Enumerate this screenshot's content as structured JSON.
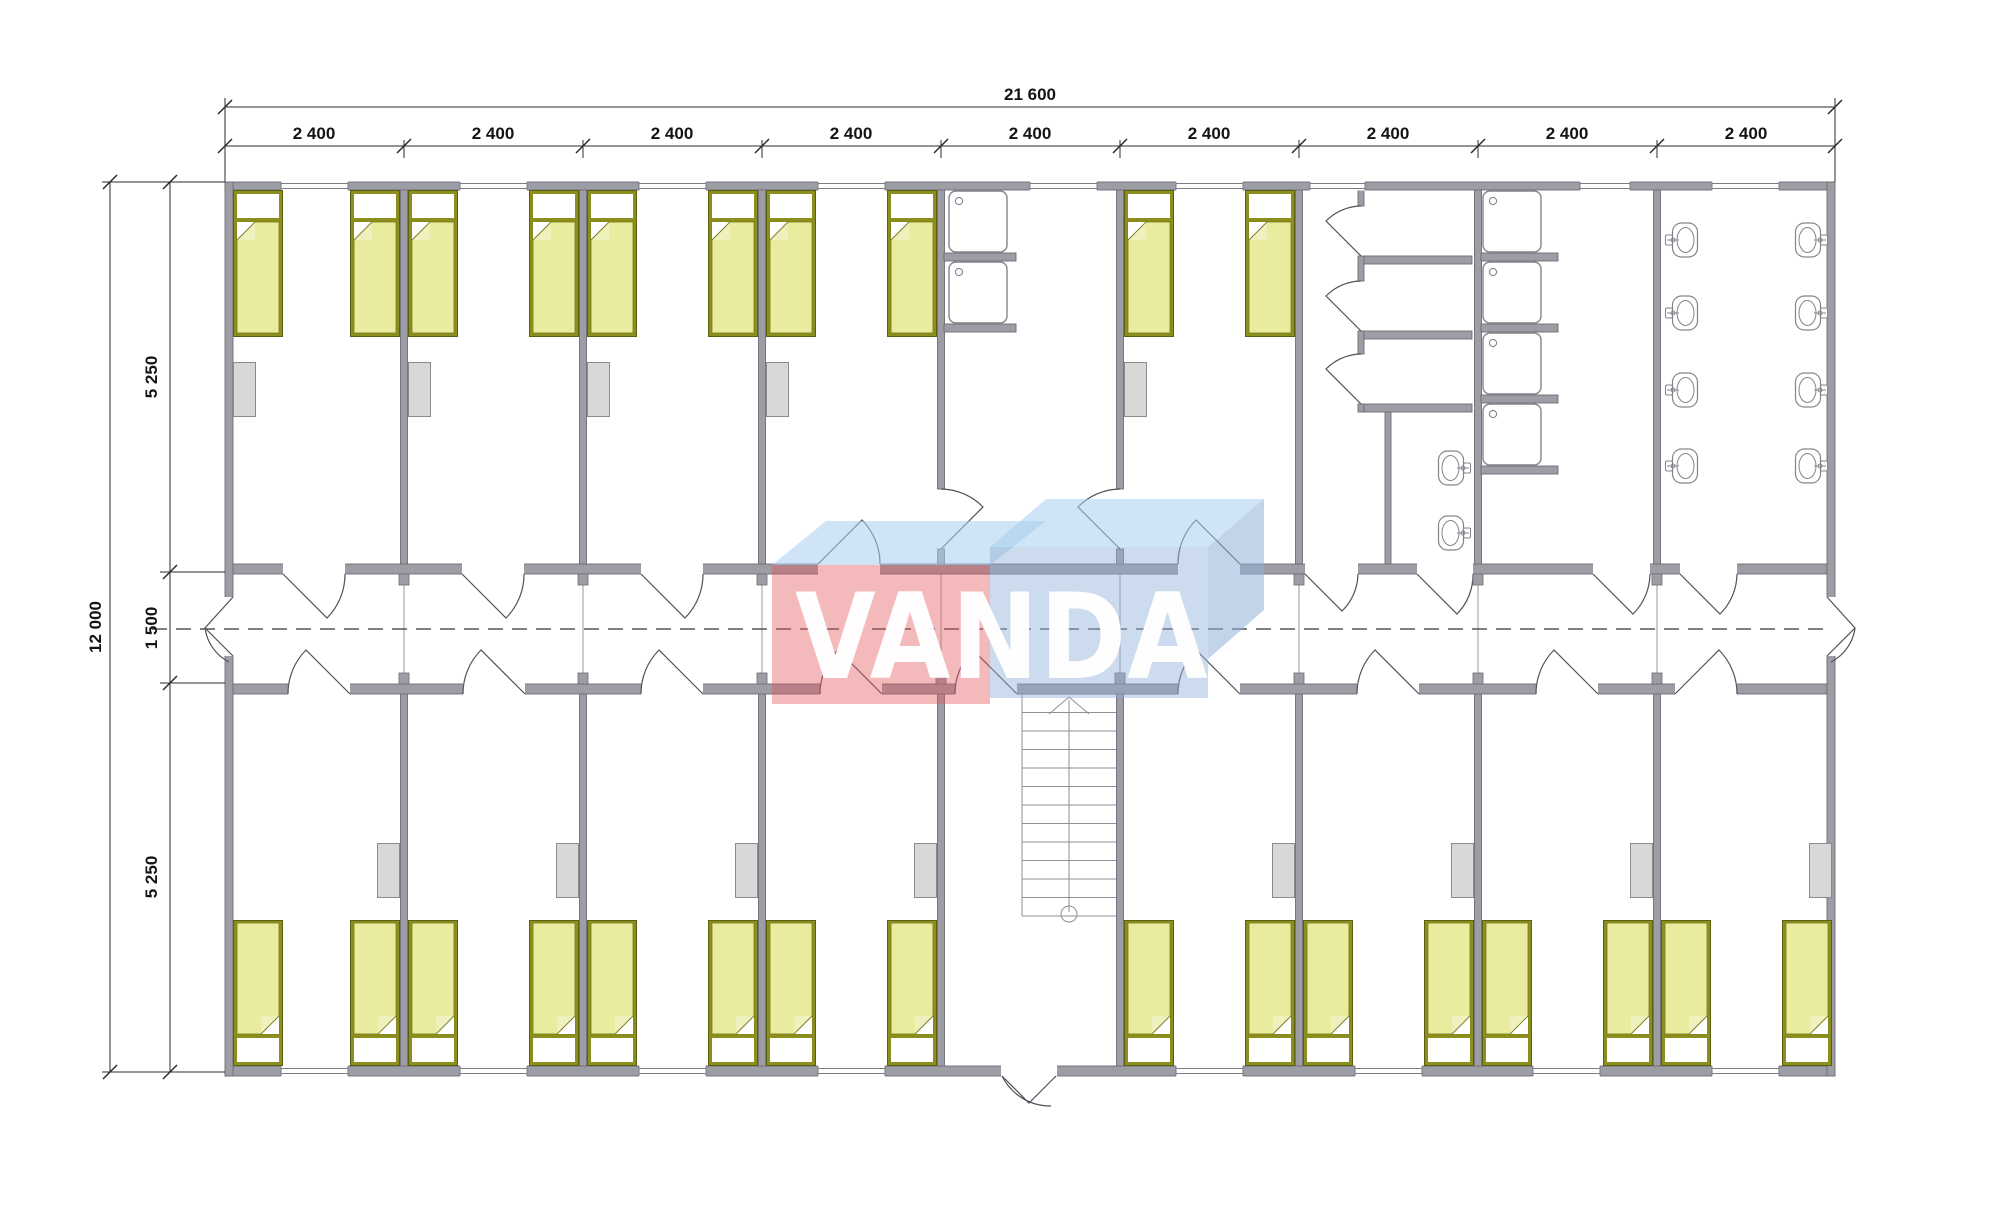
{
  "drawing": {
    "type": "floor-plan",
    "description_labels_visible": true
  },
  "dimensions": {
    "total_width_label": "21 600",
    "bay_width_labels": [
      "2 400",
      "2 400",
      "2 400",
      "2 400",
      "2 400",
      "2 400",
      "2 400",
      "2 400",
      "2 400"
    ],
    "total_height_label": "12 000",
    "height_segment_labels": [
      "5 250",
      "1 500",
      "5 250"
    ]
  },
  "watermark": {
    "text": "VANDA",
    "red": "#e2575e",
    "blue": "#8fb0d6",
    "light_blue": "#a8cdee"
  },
  "colors": {
    "wall_fill": "#9d9da5",
    "wall_edge": "#6d6d77",
    "bed_frame": "#8c8f1d",
    "bed_mattress": "#e9eb9f",
    "wardrobe": "#d8d8d8",
    "fixture_stroke": "#84848c"
  }
}
